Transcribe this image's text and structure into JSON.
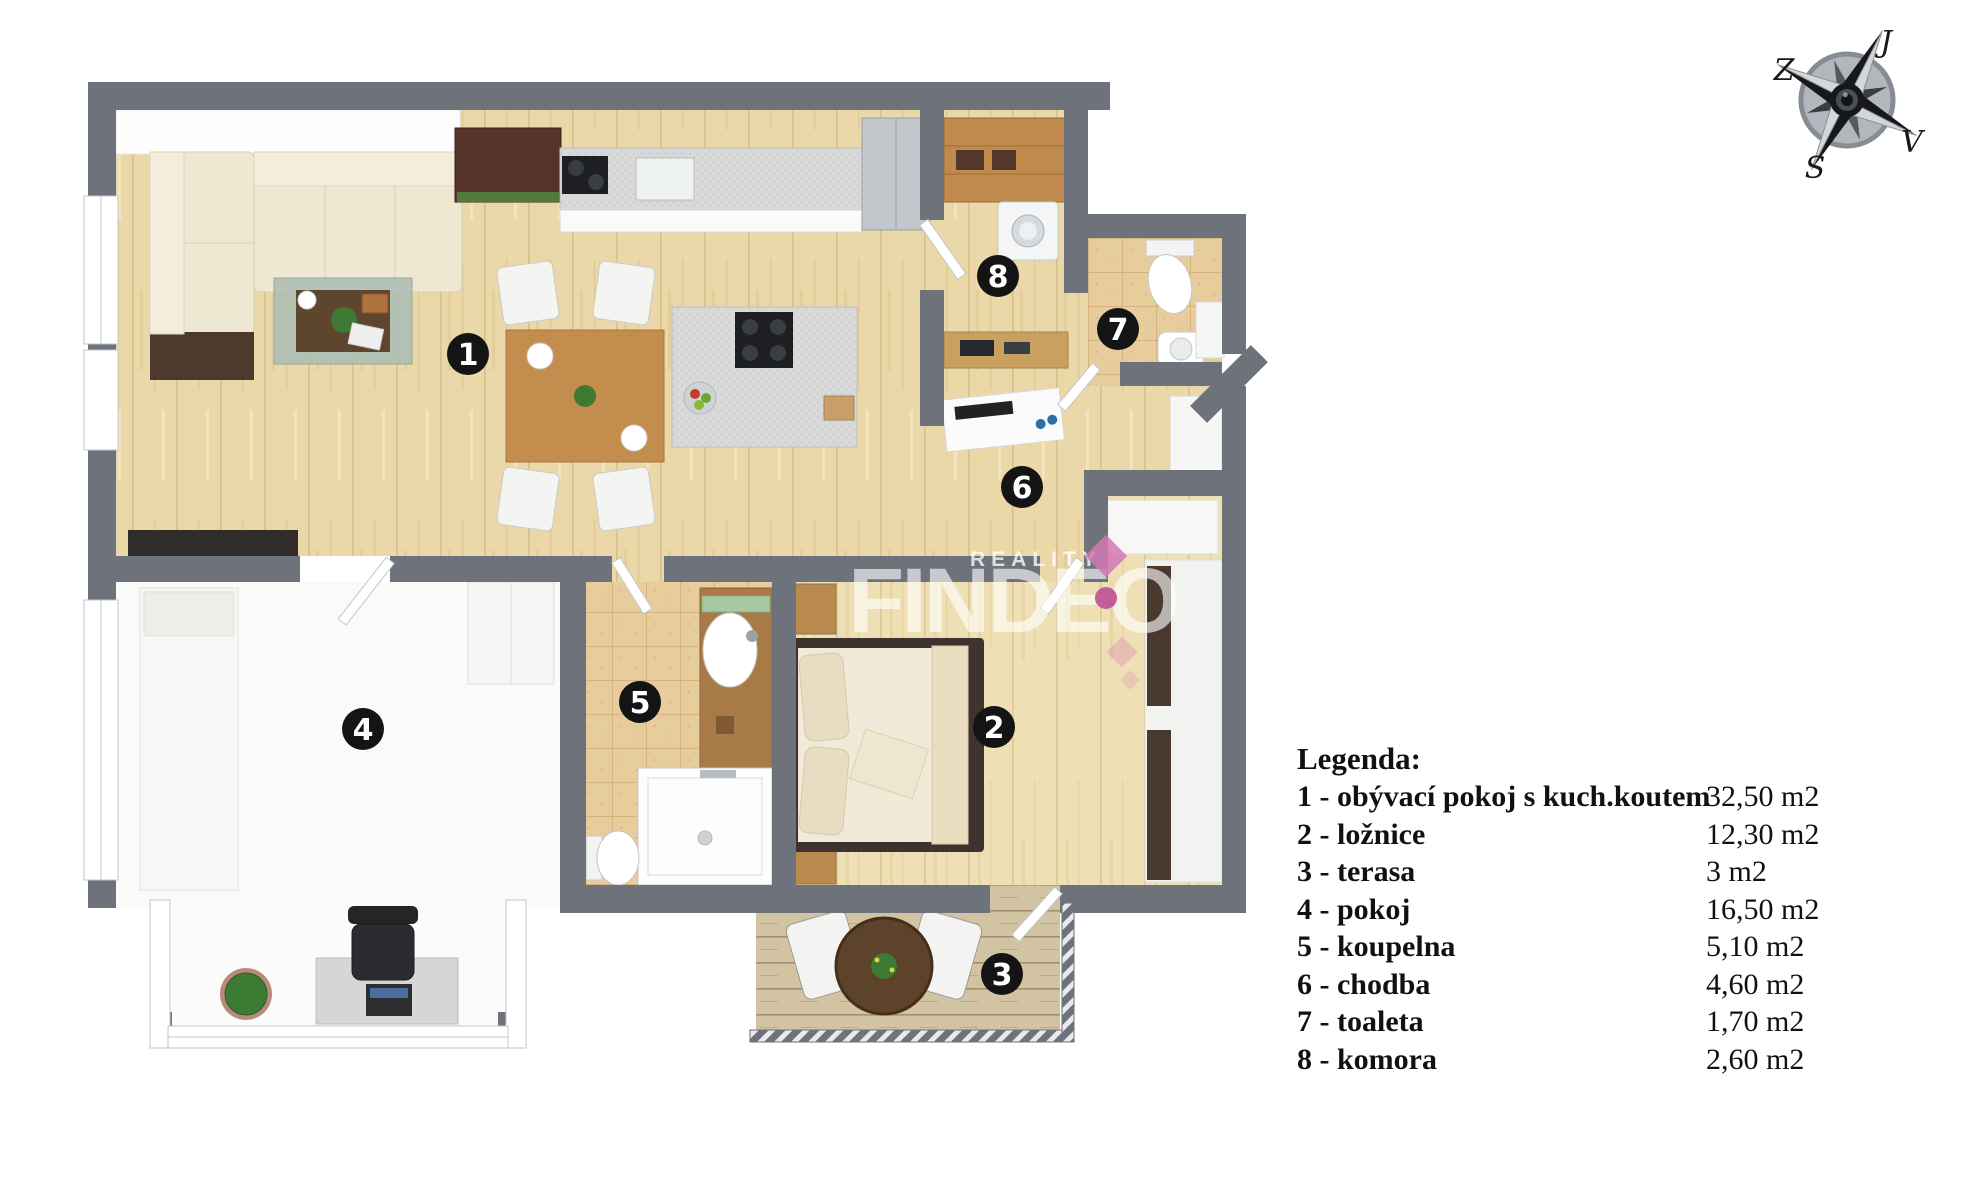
{
  "legend": {
    "title": "Legenda:",
    "items": [
      {
        "num": "1",
        "label": "1 - obývací pokoj s kuch.koutem",
        "area": "32,50 m2"
      },
      {
        "num": "2",
        "label": "2 - ložnice",
        "area": "12,30 m2"
      },
      {
        "num": "3",
        "label": "3 - terasa",
        "area": "3 m2"
      },
      {
        "num": "4",
        "label": "4 - pokoj",
        "area": "16,50 m2"
      },
      {
        "num": "5",
        "label": "5 - koupelna",
        "area": "5,10 m2"
      },
      {
        "num": "6",
        "label": "6 - chodba",
        "area": "4,60 m2"
      },
      {
        "num": "7",
        "label": "7 - toaleta",
        "area": "1,70 m2"
      },
      {
        "num": "8",
        "label": "8 - komora",
        "area": "2,60 m2"
      }
    ]
  },
  "compass": {
    "top": "J",
    "left": "Z",
    "right": "V",
    "bottom": "S"
  },
  "watermark": {
    "tagline": "REALITY",
    "brand": "FINDEO",
    "accent": "#c95f9f"
  },
  "colors": {
    "wall": "#6d727b",
    "wood": "#ebd8a8",
    "tile": "#e8cd9c",
    "terrace_wood": "#d2c4a2",
    "badge": "#141414"
  }
}
